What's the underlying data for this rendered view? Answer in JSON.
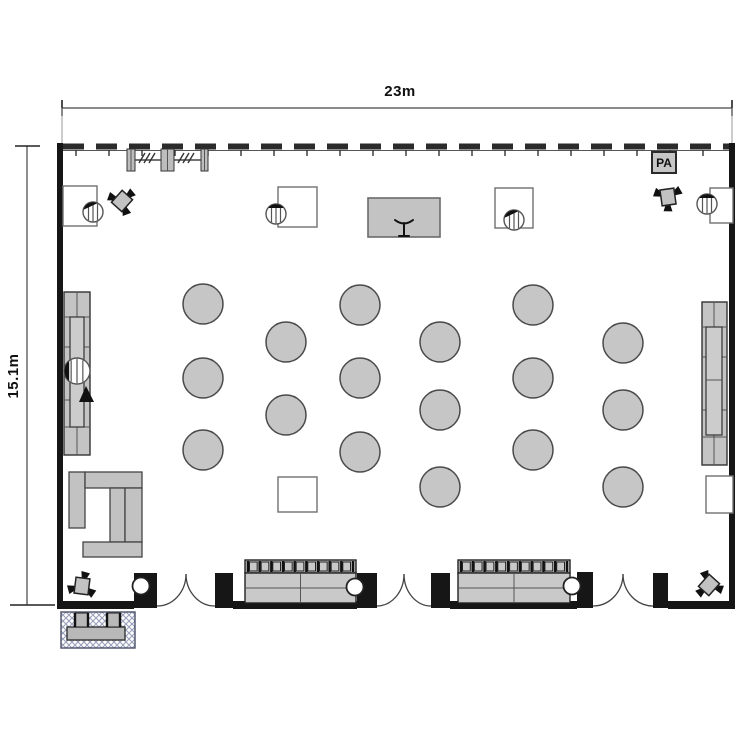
{
  "meta": {
    "type": "event-hall-floor-plan"
  },
  "dimensions": {
    "width_label": "23m",
    "height_label": "15.1m"
  },
  "pa_label": "PA",
  "colors": {
    "wall": "#161616",
    "furniture_fill": "#c6c6c6",
    "furniture_stroke": "#3a3a3a",
    "light_stroke": "#777777",
    "hatch": "#9aa0bb",
    "dim": "#444444"
  },
  "floorplan": {
    "room": {
      "x": 57,
      "y": 143,
      "w": 678,
      "h": 466
    },
    "walls": [
      [
        57,
        143,
        6,
        466
      ],
      [
        729,
        143,
        6,
        466
      ],
      [
        57,
        601,
        77,
        8
      ],
      [
        233,
        601,
        124,
        8
      ],
      [
        450,
        601,
        127,
        8
      ],
      [
        668,
        601,
        67,
        8
      ]
    ],
    "top_wall": {
      "x1": 63,
      "x2": 729,
      "y": 146.5,
      "base_y": 150.5,
      "dash": "21 12",
      "tick_y1": 150,
      "tick_y2": 156,
      "tick_step": 33
    },
    "dim_top": {
      "y": 108,
      "x1": 62,
      "x2": 732,
      "ext_y2": 143,
      "tick": 8
    },
    "dim_left": {
      "x": 27,
      "y1": 146,
      "y2": 605,
      "tick1": [
        15,
        40
      ],
      "tick2": [
        10,
        55
      ]
    },
    "piers": [
      [
        134,
        573,
        23,
        35
      ],
      [
        215,
        573,
        18,
        35
      ],
      [
        357,
        573,
        20,
        35
      ],
      [
        431,
        573,
        19,
        35
      ],
      [
        577,
        572,
        16,
        36
      ],
      [
        653,
        573,
        15,
        35
      ]
    ],
    "door_openings": [
      {
        "x1": 157,
        "x2": 215
      },
      {
        "x1": 377,
        "x2": 431
      },
      {
        "x1": 593,
        "x2": 653
      }
    ],
    "door_wall_y": 606,
    "door_peak_y": 574,
    "round_tables": {
      "r": 20,
      "centers": [
        [
          203,
          304
        ],
        [
          203,
          378
        ],
        [
          203,
          450
        ],
        [
          286,
          342
        ],
        [
          286,
          415
        ],
        [
          360,
          305
        ],
        [
          360,
          378
        ],
        [
          360,
          452
        ],
        [
          440,
          342
        ],
        [
          440,
          410
        ],
        [
          440,
          487
        ],
        [
          533,
          305
        ],
        [
          533,
          378
        ],
        [
          533,
          450
        ],
        [
          623,
          343
        ],
        [
          623,
          410
        ],
        [
          623,
          487
        ]
      ]
    },
    "square_tables": [
      [
        63,
        186,
        34,
        40
      ],
      [
        278,
        187,
        39,
        40
      ],
      [
        495,
        188,
        38,
        40
      ],
      [
        710,
        188,
        23,
        35
      ],
      [
        278,
        477,
        39,
        35
      ],
      [
        706,
        476,
        27,
        37
      ]
    ],
    "chairs": [
      {
        "cx": 93,
        "cy": 212,
        "r": 10,
        "dir": 115
      },
      {
        "cx": 276,
        "cy": 214,
        "r": 10,
        "dir": 90
      },
      {
        "cx": 514,
        "cy": 220,
        "r": 10,
        "dir": 115
      },
      {
        "cx": 707,
        "cy": 204,
        "r": 10,
        "dir": 90
      },
      {
        "cx": 77,
        "cy": 371,
        "r": 13,
        "dir": 180
      }
    ],
    "bar_chair_triangle": "79,402 94,402 86,386",
    "stage": {
      "x": 368,
      "y": 198,
      "w": 72,
      "h": 39,
      "icon": "M395 220 Q404 227 413 220 M404 223 L404 236 M399 236 L409 236"
    },
    "truss": {
      "line": [
        127,
        160,
        208,
        160
      ],
      "bars": [
        [
          127,
          149,
          8,
          22
        ],
        [
          161,
          149,
          13,
          22
        ],
        [
          201,
          149,
          7,
          22
        ]
      ],
      "slash_groups": [
        [
          147,
          158
        ],
        [
          186,
          158
        ]
      ]
    },
    "bars": {
      "left": {
        "outer": [
          64,
          292,
          26,
          163
        ],
        "vline": 77,
        "hlines": [
          317,
          347,
          400,
          427
        ],
        "inner": [
          70,
          317,
          14,
          110
        ],
        "inner_mid": 372
      },
      "right": {
        "outer": [
          702,
          302,
          25,
          163
        ],
        "vline": 714,
        "hlines": [
          327,
          357,
          410,
          437
        ],
        "inner": [
          706,
          327,
          16,
          108
        ],
        "inner_mid": 380
      }
    },
    "lounge_rects": [
      [
        69,
        472,
        16,
        56
      ],
      [
        85,
        472,
        57,
        16
      ],
      [
        110,
        488,
        15,
        54
      ],
      [
        125,
        488,
        17,
        54
      ],
      [
        83,
        542,
        59,
        15
      ]
    ],
    "sofas": [
      {
        "x": 245,
        "y": 560,
        "w": 111,
        "h": 43
      },
      {
        "x": 458,
        "y": 560,
        "w": 112,
        "h": 43
      }
    ],
    "sofa_style": {
      "back_h": 13,
      "back_segments": 9
    },
    "wall_circles": [
      [
        141,
        586
      ],
      [
        355,
        587
      ],
      [
        572,
        586
      ]
    ],
    "wall_circle_r": 8.5,
    "foh": {
      "hatch": [
        61,
        612,
        74,
        36
      ],
      "desk": [
        67,
        627,
        58,
        13
      ],
      "stools": [
        [
          75,
          613,
          13,
          14
        ],
        [
          107,
          613,
          13,
          14
        ]
      ]
    },
    "speakers": [
      {
        "cx": 122,
        "cy": 201,
        "rot": -10
      },
      {
        "cx": 668,
        "cy": 197,
        "rot": 120
      },
      {
        "cx": 82,
        "cy": 586,
        "rot": -45
      },
      {
        "cx": 709,
        "cy": 585,
        "rot": 170
      }
    ]
  }
}
